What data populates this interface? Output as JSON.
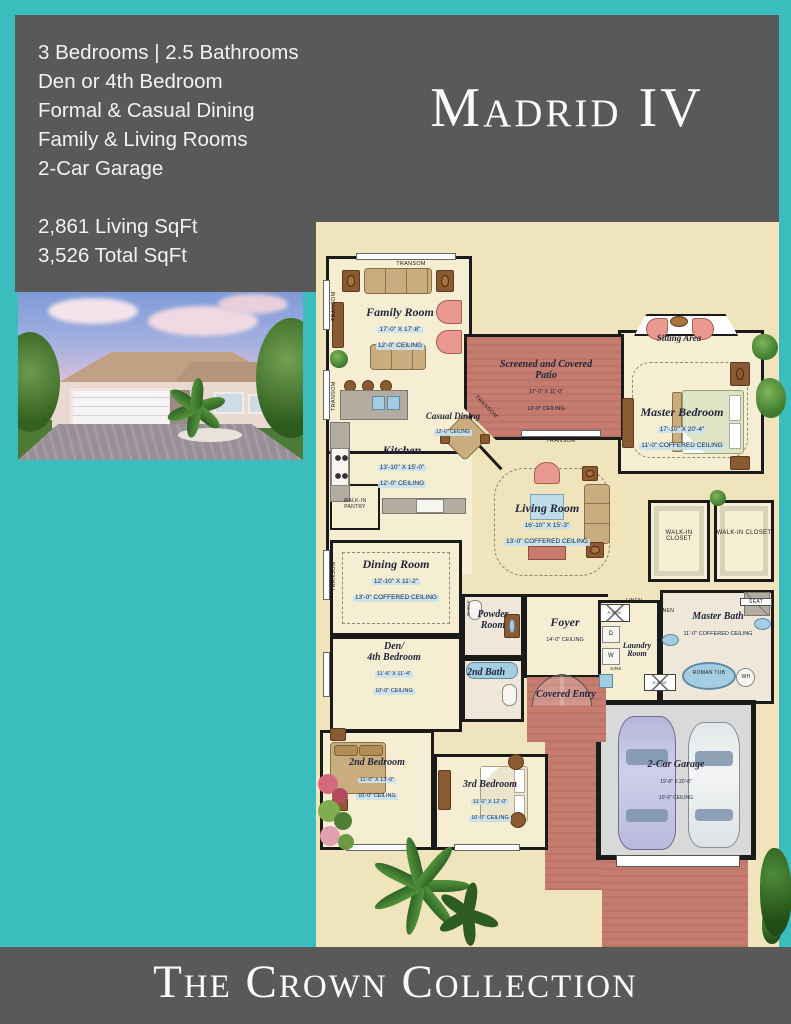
{
  "page": {
    "title": "Madrid IV",
    "footer": "The Crown Collection",
    "bg_teal": "#3bbdbd",
    "panel_gray": "#595959",
    "plan_cream": "#efe4bc",
    "patio_brick": "#c57c6f"
  },
  "header": {
    "features": [
      "3 Bedrooms  | 2.5 Bathrooms",
      "Den or 4th Bedroom",
      "Formal & Casual Dining",
      "Family & Living Rooms",
      "2-Car Garage"
    ],
    "sqft": [
      "2,861 Living SqFt",
      "3,526 Total SqFt"
    ]
  },
  "plan": {
    "rooms": {
      "family": {
        "name": "Family Room",
        "dims": "17'-0\" X 17'-8\"",
        "ceil": "12'-0\" CEILING"
      },
      "kitchen": {
        "name": "Kitchen",
        "dims": "13'-10\" X 15'-0\"",
        "ceil": "12'-0\" CEILING"
      },
      "casual": {
        "name": "Casual Dining",
        "ceil": "12'-0\" CEILING"
      },
      "patio": {
        "name": "Screened and Covered Patio",
        "dims": "17'-0\" X 11'-0\"",
        "ceil": "12'-0\" CEILING"
      },
      "sitting": {
        "name": "Sitting Area"
      },
      "master": {
        "name": "Master Bedroom",
        "dims": "17'-10\" X 20'-4\"",
        "ceil": "11'-0\" COFFERED CEILING"
      },
      "living": {
        "name": "Living Room",
        "dims": "16'-10\" X 15'-3\"",
        "ceil": "13'-0\" COFFERED CEILING"
      },
      "dining": {
        "name": "Dining Room",
        "dims": "12'-10\" X 11'-2\"",
        "ceil": "13'-0\" COFFERED CEILING"
      },
      "den": {
        "name1": "Den/",
        "name2": "4th Bedroom",
        "dims": "11'-6\" X 11'-4\"",
        "ceil": "10'-0\" CEILING"
      },
      "powder": {
        "name": "Powder Room"
      },
      "foyer": {
        "name": "Foyer",
        "ceil": "14'-0\" CEILING"
      },
      "bath2": {
        "name": "2nd Bath"
      },
      "laundry": {
        "name": "Laundry Room"
      },
      "masterbath": {
        "name": "Master Bath",
        "ceil": "11'-0\" COFFERED CEILING"
      },
      "entry": {
        "name": "Covered Entry"
      },
      "bed2": {
        "name": "2nd Bedroom",
        "dims": "11'-0\" X 13'-0\"",
        "ceil": "10'-0\" CEILING"
      },
      "bed3": {
        "name": "3rd Bedroom",
        "dims": "11'-0\" X 12'-0\"",
        "ceil": "10'-0\" CEILING"
      },
      "garage": {
        "name": "2-Car Garage",
        "dims": "19'-8\" X 20'-0\"",
        "ceil": "10'-0\" CEILING"
      },
      "pantry": {
        "name": "WALK-IN PANTRY"
      },
      "wic": {
        "name": "WALK-IN CLOSET"
      }
    },
    "labels": {
      "transom": "TRANSOM",
      "linen": "LINEN",
      "shelf": "SHELF",
      "seat": "SEAT",
      "ahu": "A.H.U.",
      "d": "D",
      "w": "W",
      "sink": "SINK",
      "roman": "ROMAN TUB",
      "wh": "WH"
    }
  }
}
